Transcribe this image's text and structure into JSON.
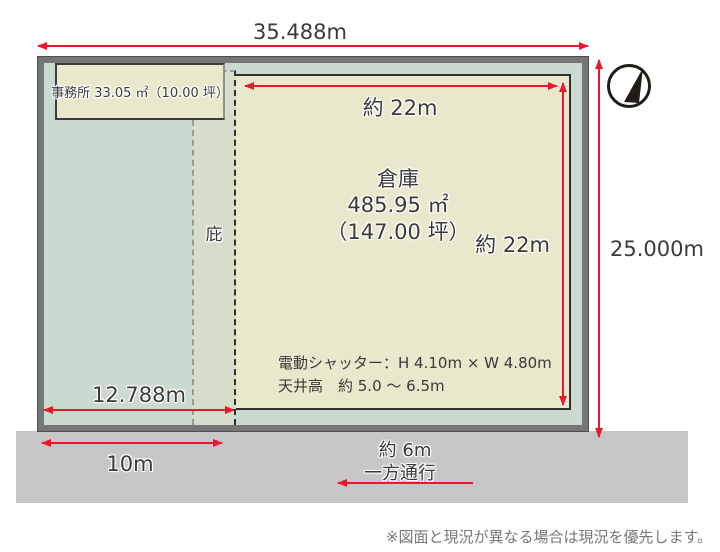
{
  "colors": {
    "red": "#e8192c",
    "green": "#cadacf",
    "strip": "#d6ddcb",
    "cream": "#eae8cc",
    "road": "#c6c6c8",
    "frame": "#767676",
    "ink": "#3a3a3a"
  },
  "dimensions": {
    "top_width": "35.488m",
    "right_height": "25.000m",
    "warehouse_width": "約 22m",
    "warehouse_height": "約 22m",
    "left_inner_width": "12.788m",
    "road_frontage": "10m",
    "road_width": "約 6m"
  },
  "labels": {
    "office": "事務所 33.05 ㎡（10.00 坪）",
    "canopy": "庇",
    "warehouse_name": "倉庫",
    "warehouse_area_m2": "485.95 ㎡",
    "warehouse_area_tsubo": "（147.00 坪）",
    "shutter": "電動シャッター：H 4.10m × W 4.80m",
    "ceiling": "天井高　約 5.0 ～ 6.5m",
    "one_way": "一方通行",
    "disclaimer": "※図面と現況が異なる場合は現況を優先します。"
  },
  "icons": {
    "compass": "north-arrow-compass"
  }
}
